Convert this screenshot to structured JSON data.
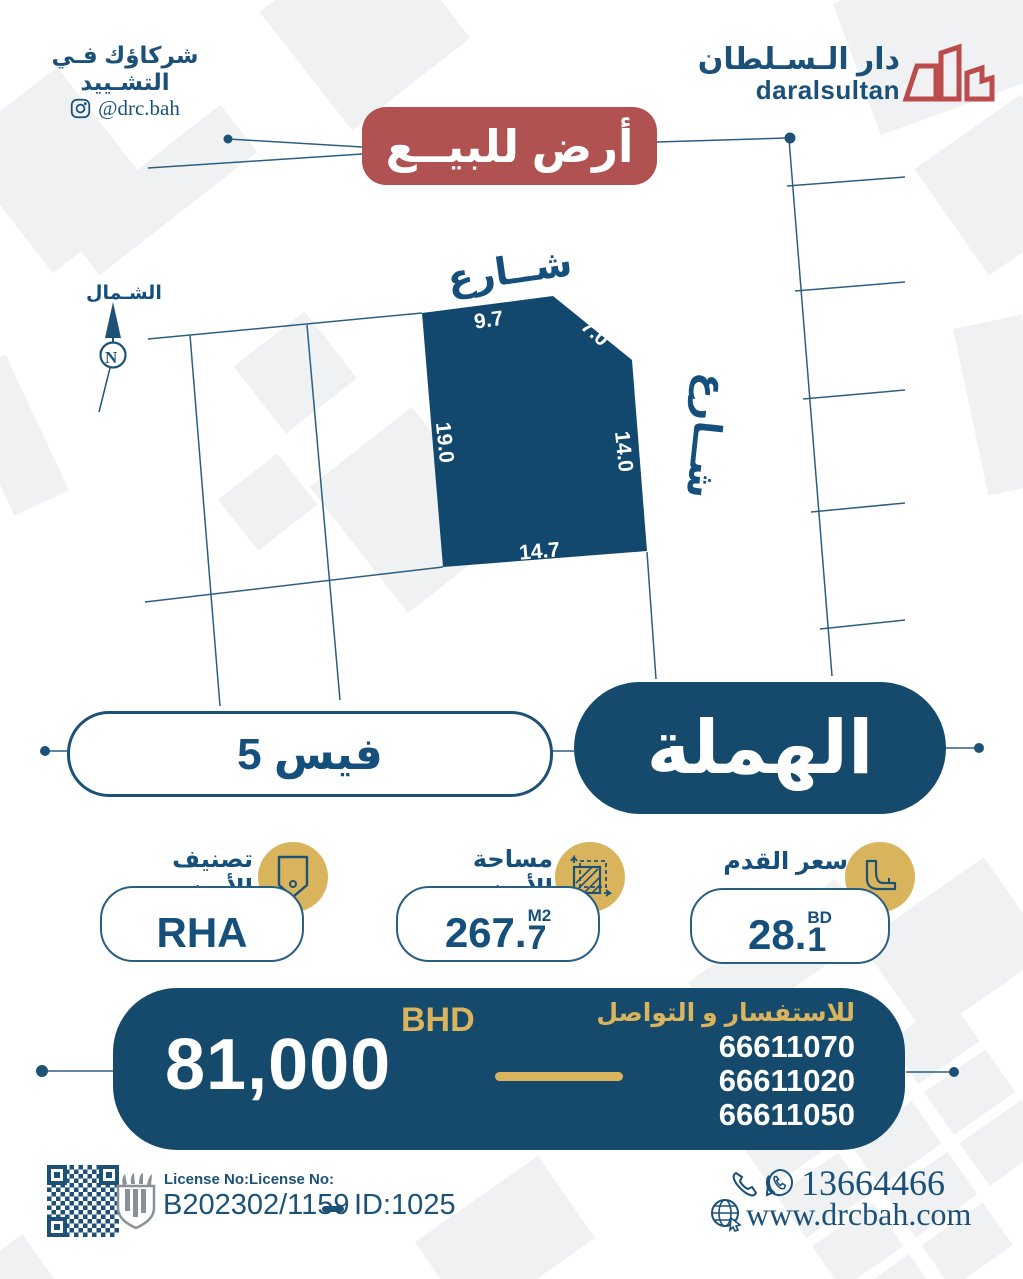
{
  "header": {
    "tagline": "شركاؤك فـي التشـييد",
    "instagram_handle": "@drc.bah",
    "brand_ar": "دار الـسـلطان",
    "brand_en": "daralsultan"
  },
  "badge": {
    "label": "أرض للبيــع"
  },
  "map": {
    "north_label": "الشـمال",
    "north_letter": "N",
    "street_top": "شــارع",
    "street_right": "شــارع",
    "plot_dimensions": {
      "top": "9.7",
      "corner": "7.0",
      "left": "19.0",
      "right": "14.0",
      "bottom": "14.7"
    }
  },
  "location": {
    "block_label": "فيس 5",
    "area_name": "الهملة"
  },
  "stats": {
    "classification": {
      "label": "تصنيف الأرض",
      "value": "RHA"
    },
    "area": {
      "label": "مساحة الأرض",
      "value_int": "267.",
      "value_dec": "7",
      "unit": "M2"
    },
    "price_per_foot": {
      "label": "سعر القدم",
      "value_int": "28.",
      "value_dec": "1",
      "unit": "BD"
    }
  },
  "price": {
    "currency": "BHD",
    "amount": "81,000",
    "contact_label": "للاستفسار و التواصل",
    "phones": [
      "66611070",
      "66611020",
      "66611050"
    ]
  },
  "footer": {
    "license_label": "License No:License No:",
    "license_no": "B202302/1159",
    "listing_id": "ID:1025",
    "phone": "13664466",
    "website": "www.drcbah.com"
  },
  "colors": {
    "navy": "#164a6c",
    "red": "#b05252",
    "gold": "#d9b45c",
    "line_blue": "#2b5f82",
    "text_blue": "#1b5078",
    "shape_gray": "#eff1f2"
  }
}
